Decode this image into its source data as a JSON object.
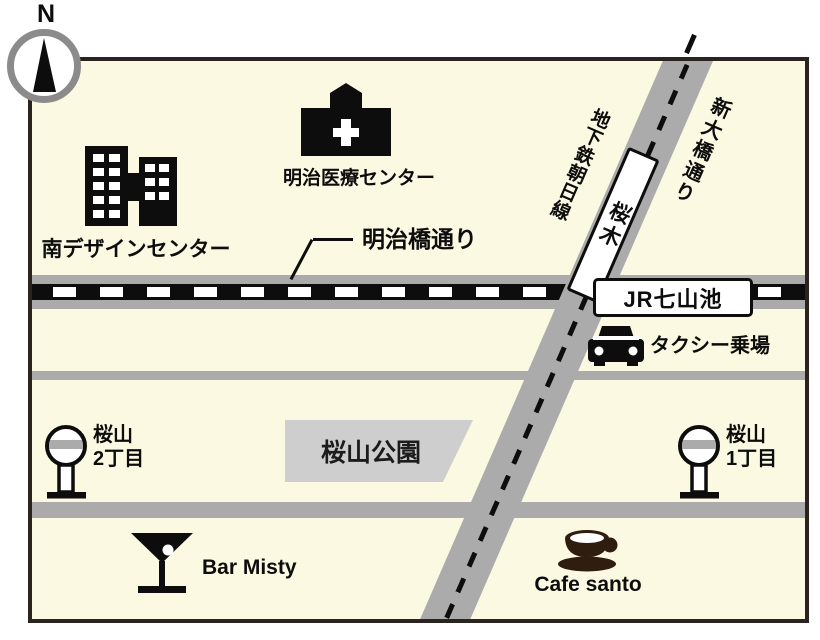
{
  "compass": {
    "north_label": "N"
  },
  "landmarks": {
    "design_center": {
      "label": "南デザインセンター"
    },
    "medical_center": {
      "label": "明治医療センター"
    },
    "park": {
      "label": "桜山公園"
    },
    "taxi_stand": {
      "label": "タクシー乗場"
    },
    "bar": {
      "label": "Bar Misty"
    },
    "cafe": {
      "label": "Cafe santo"
    }
  },
  "roads": {
    "meijibashi_street": {
      "label": "明治橋通り"
    },
    "shin_ohashi_street": {
      "label": "新大橋通り"
    }
  },
  "transit": {
    "jr_station": {
      "label": "JR七山池"
    },
    "subway_line": {
      "label": "地下鉄朝日線"
    },
    "subway_station": {
      "label": "桜木"
    }
  },
  "bus_stops": {
    "chome2": {
      "name": "桜山",
      "block": "2丁目"
    },
    "chome1": {
      "name": "桜山",
      "block": "1丁目"
    }
  },
  "colors": {
    "map_background": "#fcf9e2",
    "road_gray": "#ababab",
    "park_gray": "#cecece",
    "outline_dark": "#2b2320",
    "rail_black": "#0d0d0d",
    "cafe_brown": "#2f1d10",
    "compass_ring": "#8b8b8b"
  }
}
